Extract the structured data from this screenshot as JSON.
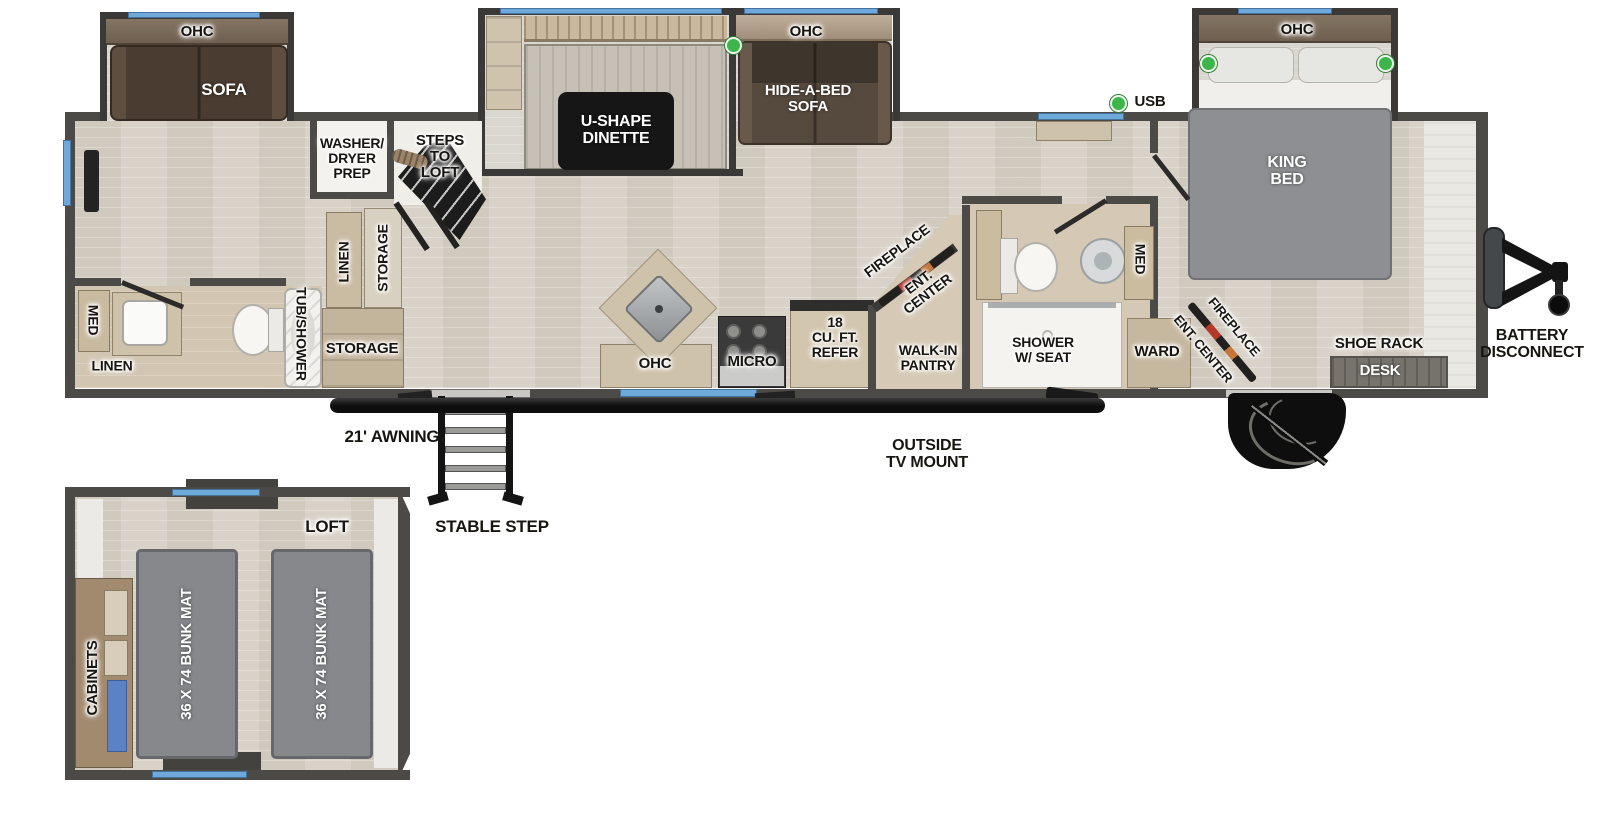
{
  "labels": {
    "ohc_rear": "OHC",
    "sofa": "SOFA",
    "washer_dryer_prep": "WASHER/\nDRYER\nPREP",
    "steps_to_loft": "STEPS\nTO\nLOFT",
    "u_shape_dinette": "U-SHAPE\nDINETTE",
    "ohc_hide_a_bed": "OHC",
    "hide_a_bed_sofa": "HIDE-A-BED\nSOFA",
    "usb": "USB",
    "ohc_king": "OHC",
    "king_bed": "KING\nBED",
    "battery_disconnect": "BATTERY\nDISCONNECT",
    "med_rear": "MED",
    "linen_rear": "LINEN",
    "tub_shower": "TUB/SHOWER",
    "linen_tall": "LINEN",
    "storage_tall": "STORAGE",
    "storage_cabinet": "STORAGE",
    "ohc_kitchen": "OHC",
    "micro": "MICRO",
    "refer": "18\nCU. FT.\nREFER",
    "fireplace_kitchen": "FIREPLACE",
    "ent_center_kitchen": "ENT.\nCENTER",
    "walk_in_pantry": "WALK-IN\nPANTRY",
    "shower_w_seat": "SHOWER\nW/ SEAT",
    "med_mid": "MED",
    "ward": "WARD",
    "ent_center_bedroom": "ENT. CENTER",
    "fireplace_bedroom": "FIREPLACE",
    "shoe_rack": "SHOE RACK",
    "desk": "DESK",
    "awning": "21' AWNING",
    "outside_tv_mount": "OUTSIDE\nTV MOUNT",
    "stable_step": "STABLE STEP",
    "loft": "LOFT",
    "cabinets": "CABINETS",
    "bunk_mat_left": "36 X 74 BUNK MAT",
    "bunk_mat_right": "36 X 74 BUNK MAT"
  },
  "colors": {
    "wall": "#4c4a47",
    "floor_wood": "#d8d2c8",
    "floor_tan": "#d2c6b2",
    "window_blue": "#6fa9dc",
    "usb_green": "#3cb54a",
    "fireplace_red": "#b3382c",
    "sofa_brown": "#4a3c30",
    "mattress_gray": "#8d8f92",
    "table_black": "#161616"
  }
}
